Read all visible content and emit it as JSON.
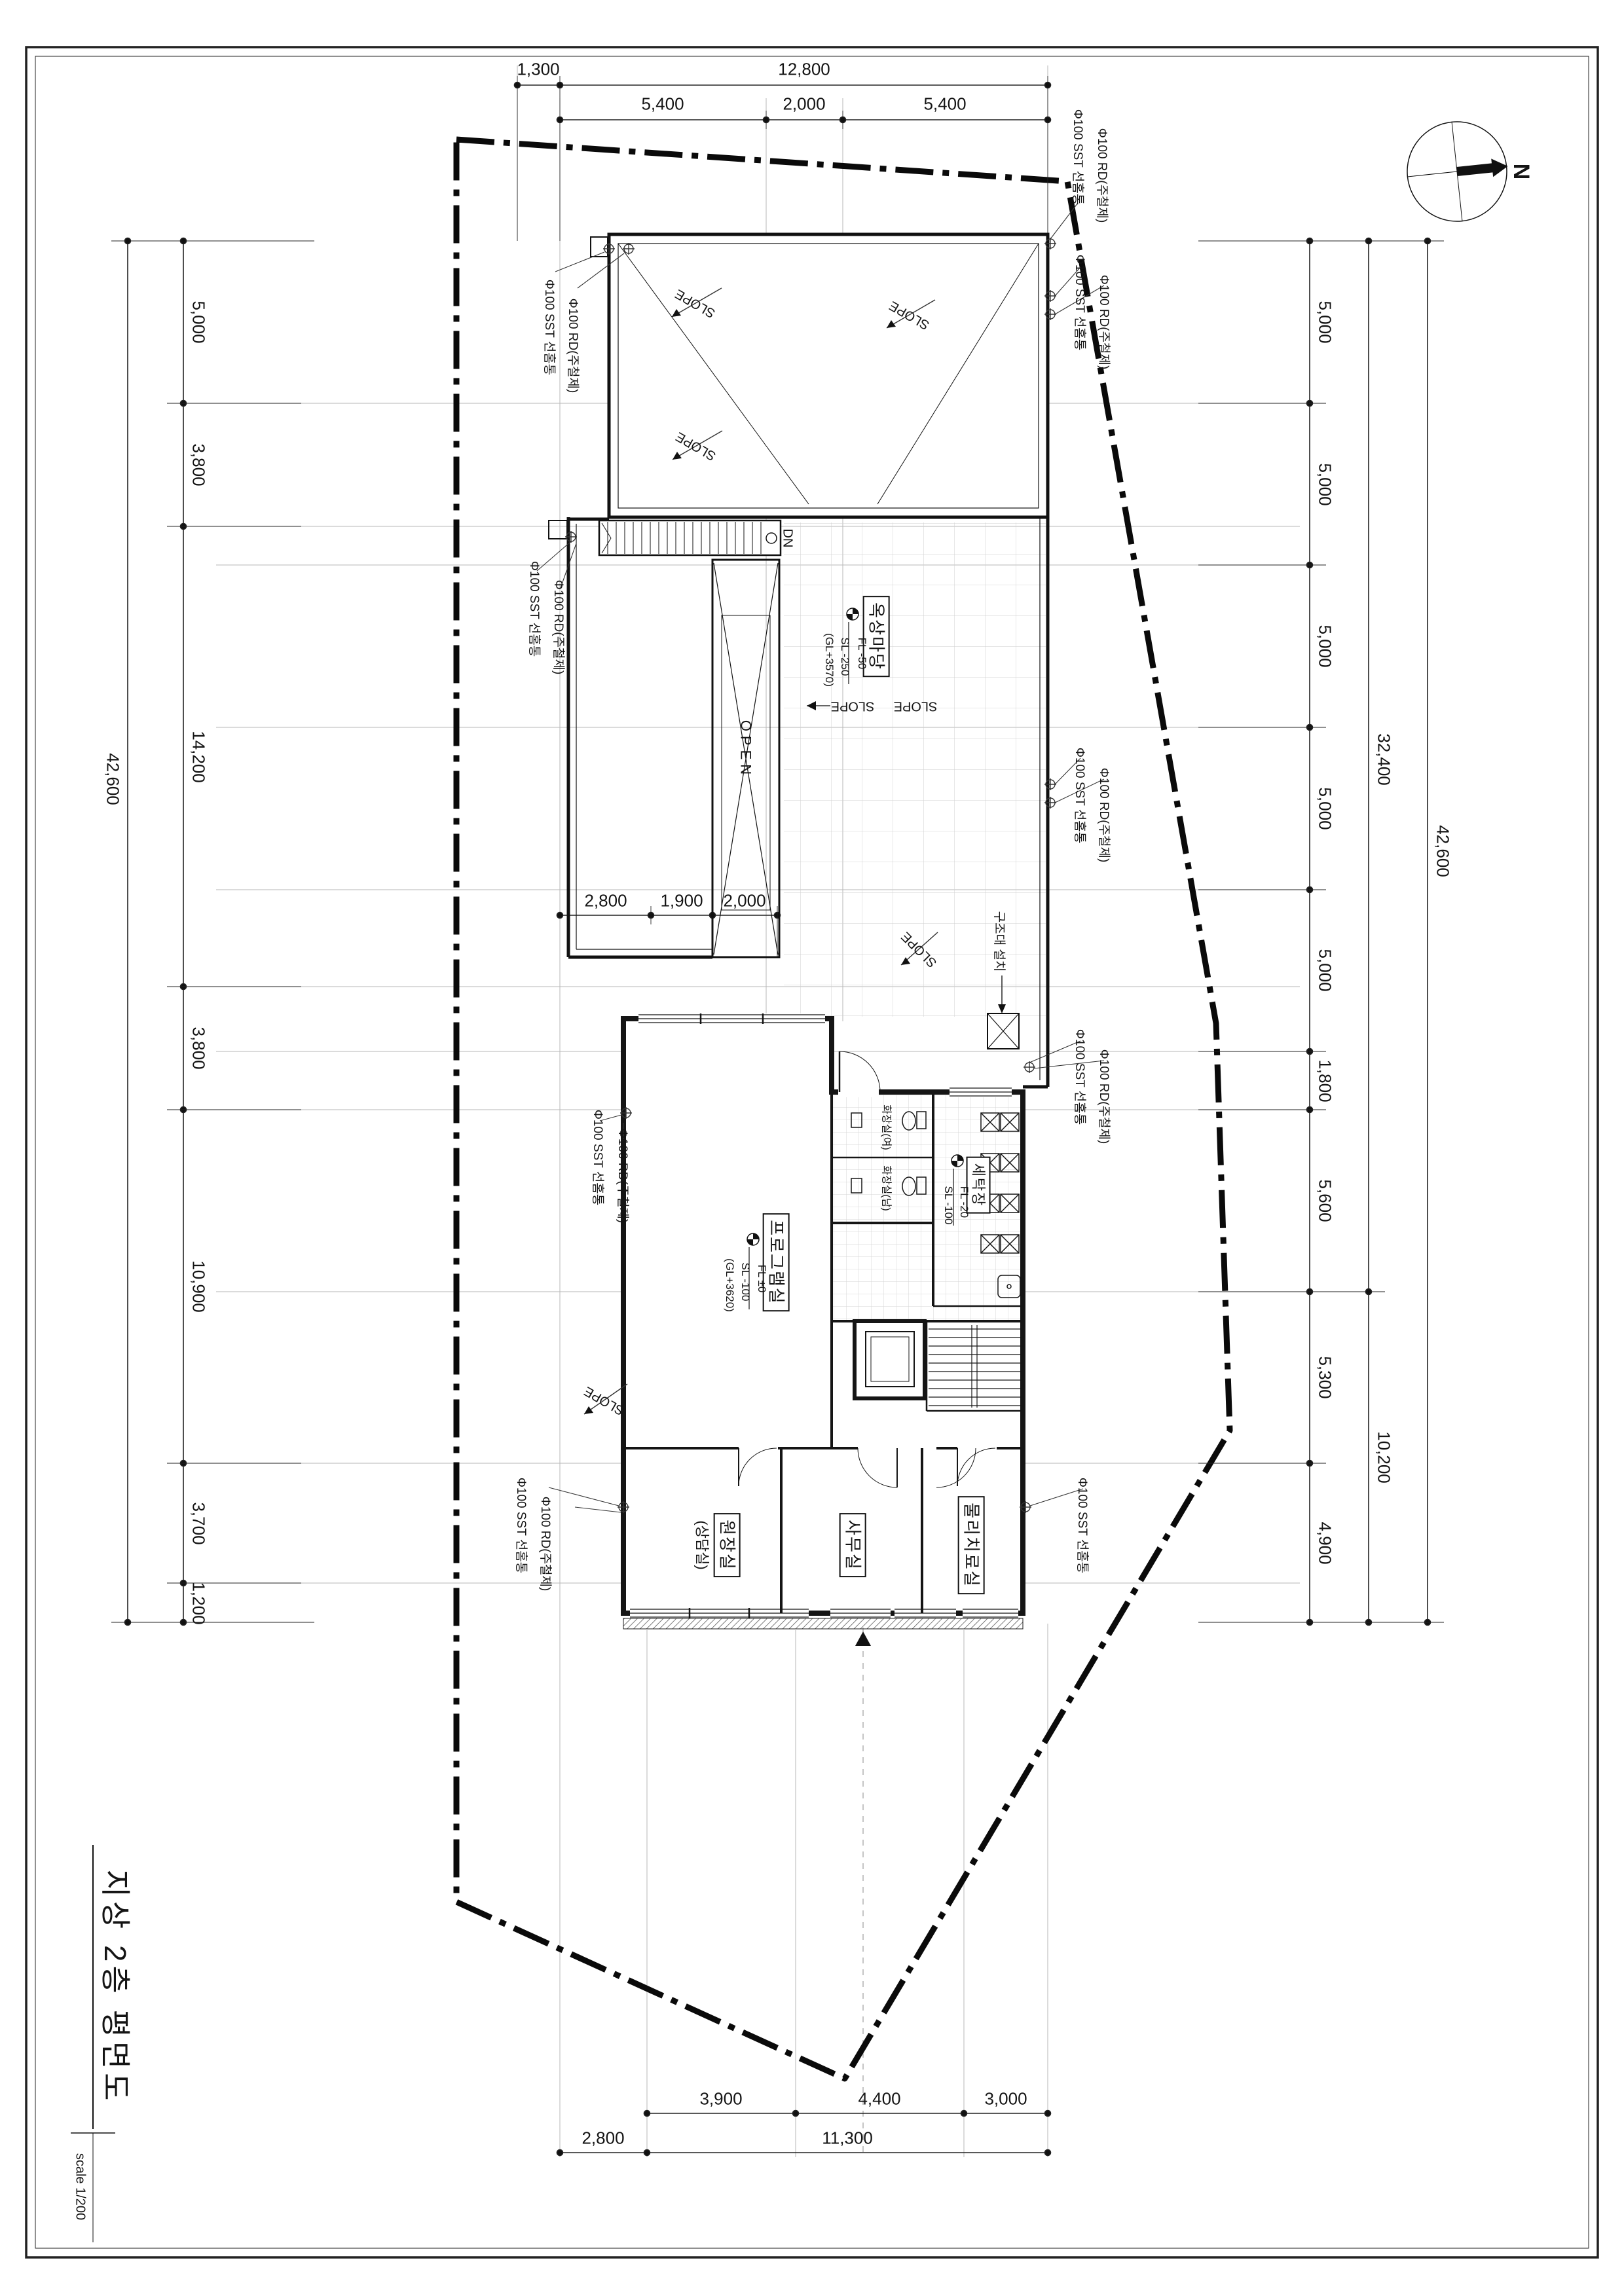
{
  "title": {
    "text": "지상 2층 평면도",
    "scale": "scale 1/200"
  },
  "north": {
    "label": "N"
  },
  "dims": {
    "top_overall": [
      "1,300",
      "12,800"
    ],
    "top_sub": [
      "5,400",
      "2,000",
      "5,400"
    ],
    "left": [
      "5,000",
      "3,800",
      "14,200",
      "3,800",
      "10,900",
      "3,700",
      "1,200"
    ],
    "right": [
      "5,000",
      "5,000",
      "5,000",
      "5,000",
      "5,000",
      "1,800",
      "5,600",
      "5,300",
      "4,900"
    ],
    "right_mid": [
      "32,400",
      "10,200"
    ],
    "total": "42,600",
    "roof": [
      "2,800",
      "1,900",
      "2,000"
    ],
    "bottom_sub": [
      "3,900",
      "4,400",
      "3,000"
    ],
    "bottom_overall": [
      "2,800",
      "11,300"
    ]
  },
  "rooms": {
    "roof_yard": {
      "name": "옥상마당",
      "levels": [
        "FL -50",
        "SL -250",
        "(GL+3570)"
      ]
    },
    "program": {
      "name": "프로그램실",
      "levels": [
        "FL ±0",
        "SL -100",
        "(GL+3620)"
      ]
    },
    "laundry": {
      "name": "세탁장",
      "levels": [
        "FL -20",
        "SL -100"
      ]
    },
    "toilet_w": "화장실(여)",
    "toilet_m": "화장실(남)",
    "director": {
      "name": "원장실",
      "sub": "(상담실)"
    },
    "office": "사무실",
    "therapy": "물리치료실"
  },
  "annotations": {
    "sst": "Φ100 SST 선홈통",
    "rd": "Φ100 RD(주철제)",
    "rescue": "구조대 설치",
    "dn": "DN",
    "open": "OPEN",
    "slope": "SLOPE"
  }
}
